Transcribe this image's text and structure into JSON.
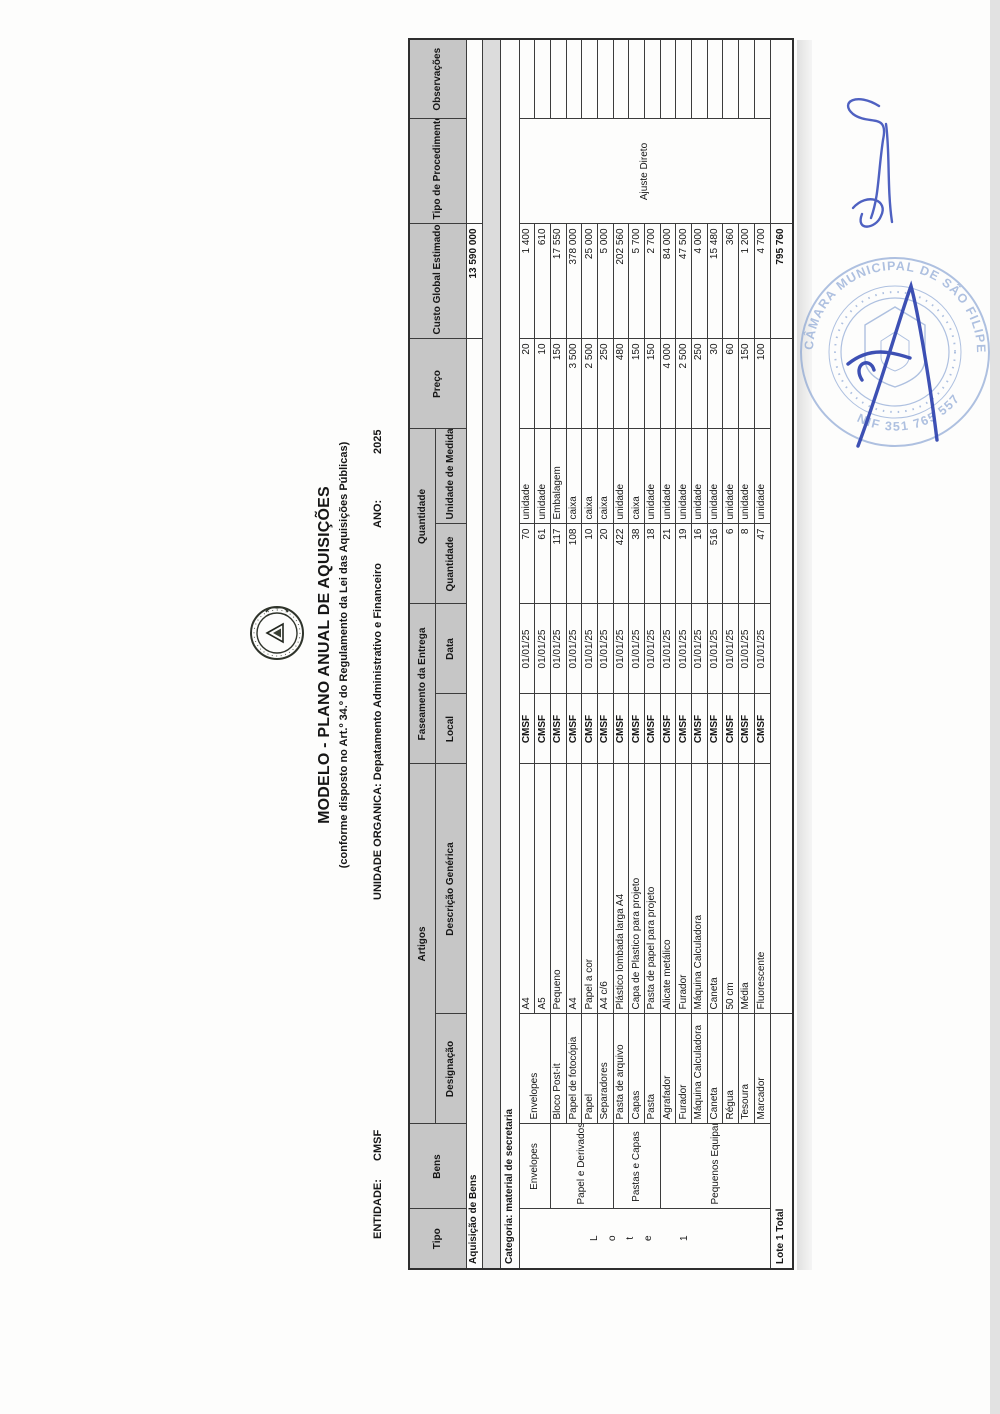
{
  "page": {
    "title": "MODELO - PLANO ANUAL DE AQUISIÇÕES",
    "subtitle": "(conforme disposto no Art.º 34.º do Regulamento da Lei das Aquisições Públicas)",
    "entidade_label": "ENTIDADE:",
    "entidade_value": "CMSF",
    "unidade_organica": "UNIDADE ORGANICA: Depatamento Administrativo e Financeiro",
    "ano_label": "ANO:",
    "ano_value": "2025"
  },
  "table": {
    "headers": {
      "tipo": "Tipo",
      "bens": "Bens",
      "artigos": "Artigos",
      "designacao": "Designação",
      "descricao": "Descrição Genérica",
      "faseamento": "Faseamento da Entrega",
      "local": "Local",
      "data": "Data",
      "quantidade_group": "Quantidade",
      "quantidade": "Quantidade",
      "unidade": "Unidade de Medida",
      "preco": "Preço",
      "custo": "Custo Global Estimado",
      "procedimento": "Tipo de Procedimento (indicativo)",
      "observacoes": "Observações"
    },
    "section1": {
      "label": "Aquisição de Bens",
      "custo_total": "13 590 000"
    },
    "section2": {
      "label": "Categoria: material de secretaria"
    },
    "lote_label": "Lote 1",
    "procedimento_value": "Ajuste Direto",
    "bens_groups": [
      {
        "label": "Envelopes"
      },
      {
        "label": "Papel e Derivados"
      },
      {
        "label": "Pastas e Capas"
      },
      {
        "label": "Pequenos Equipamentos"
      }
    ],
    "rows": [
      {
        "designacao": "Envelopes",
        "descricao": "A4",
        "local": "CMSF",
        "data": "01/01/25",
        "qtd": "70",
        "unidade": "unidade",
        "preco": "20",
        "custo": "1 400"
      },
      {
        "descricao": "A5",
        "local": "CMSF",
        "data": "01/01/25",
        "qtd": "61",
        "unidade": "unidade",
        "preco": "10",
        "custo": "610"
      },
      {
        "designacao": "Bloco Post-it",
        "descricao": "Pequeno",
        "local": "CMSF",
        "data": "01/01/25",
        "qtd": "117",
        "unidade": "Embalagem",
        "preco": "150",
        "custo": "17 550"
      },
      {
        "designacao": "Papel de fotocópia",
        "descricao": "A4",
        "local": "CMSF",
        "data": "01/01/25",
        "qtd": "108",
        "unidade": "caixa",
        "preco": "3 500",
        "custo": "378 000"
      },
      {
        "designacao": "Papel",
        "descricao": "Papel a cor",
        "local": "CMSF",
        "data": "01/01/25",
        "qtd": "10",
        "unidade": "caixa",
        "preco": "2 500",
        "custo": "25 000"
      },
      {
        "designacao": "Separadores",
        "descricao": "A4 c/6",
        "local": "CMSF",
        "data": "01/01/25",
        "qtd": "20",
        "unidade": "caixa",
        "preco": "250",
        "custo": "5 000"
      },
      {
        "designacao": "Pasta de arquivo",
        "descricao": "Plástico lombada larga A4",
        "local": "CMSF",
        "data": "01/01/25",
        "qtd": "422",
        "unidade": "unidade",
        "preco": "480",
        "custo": "202 560"
      },
      {
        "designacao": "Capas",
        "descricao": "Capa de Plastico para projeto",
        "local": "CMSF",
        "data": "01/01/25",
        "qtd": "38",
        "unidade": "caixa",
        "preco": "150",
        "custo": "5 700"
      },
      {
        "designacao": "Pasta",
        "descricao": "Pasta de papel para projeto",
        "local": "CMSF",
        "data": "01/01/25",
        "qtd": "18",
        "unidade": "unidade",
        "preco": "150",
        "custo": "2 700"
      },
      {
        "designacao": "Agrafador",
        "descricao": "Alicate metálico",
        "local": "CMSF",
        "data": "01/01/25",
        "qtd": "21",
        "unidade": "unidade",
        "preco": "4 000",
        "custo": "84 000"
      },
      {
        "designacao": "Furador",
        "descricao": "Furador",
        "local": "CMSF",
        "data": "01/01/25",
        "qtd": "19",
        "unidade": "unidade",
        "preco": "2 500",
        "custo": "47 500"
      },
      {
        "designacao": "Máquina Calculadora",
        "descricao": "Máquina Calculadora",
        "local": "CMSF",
        "data": "01/01/25",
        "qtd": "16",
        "unidade": "unidade",
        "preco": "250",
        "custo": "4 000"
      },
      {
        "designacao": "Caneta",
        "descricao": "Caneta",
        "local": "CMSF",
        "data": "01/01/25",
        "qtd": "516",
        "unidade": "unidade",
        "preco": "30",
        "custo": "15 480"
      },
      {
        "designacao": "Régua",
        "descricao": "50 cm",
        "local": "CMSF",
        "data": "01/01/25",
        "qtd": "6",
        "unidade": "unidade",
        "preco": "60",
        "custo": "360"
      },
      {
        "designacao": "Tesoura",
        "descricao": "Média",
        "local": "CMSF",
        "data": "01/01/25",
        "qtd": "8",
        "unidade": "unidade",
        "preco": "150",
        "custo": "1 200"
      },
      {
        "designacao": "Marcador",
        "descricao": "Fluorescente",
        "local": "CMSF",
        "data": "01/01/25",
        "qtd": "47",
        "unidade": "unidade",
        "preco": "100",
        "custo": "4 700"
      }
    ],
    "total": {
      "label": "Lote 1 Total",
      "custo": "795 760"
    }
  },
  "stamp": {
    "ring_top": "CÂMARA MUNICIPAL DE SÃO FILIPE - FOGO",
    "ring_bottom": "NIF 351 765 557"
  },
  "colors": {
    "header_gray": "#c6c6c6",
    "stamp_blue": "#7e9ccf",
    "ink_blue": "#4054bc"
  }
}
